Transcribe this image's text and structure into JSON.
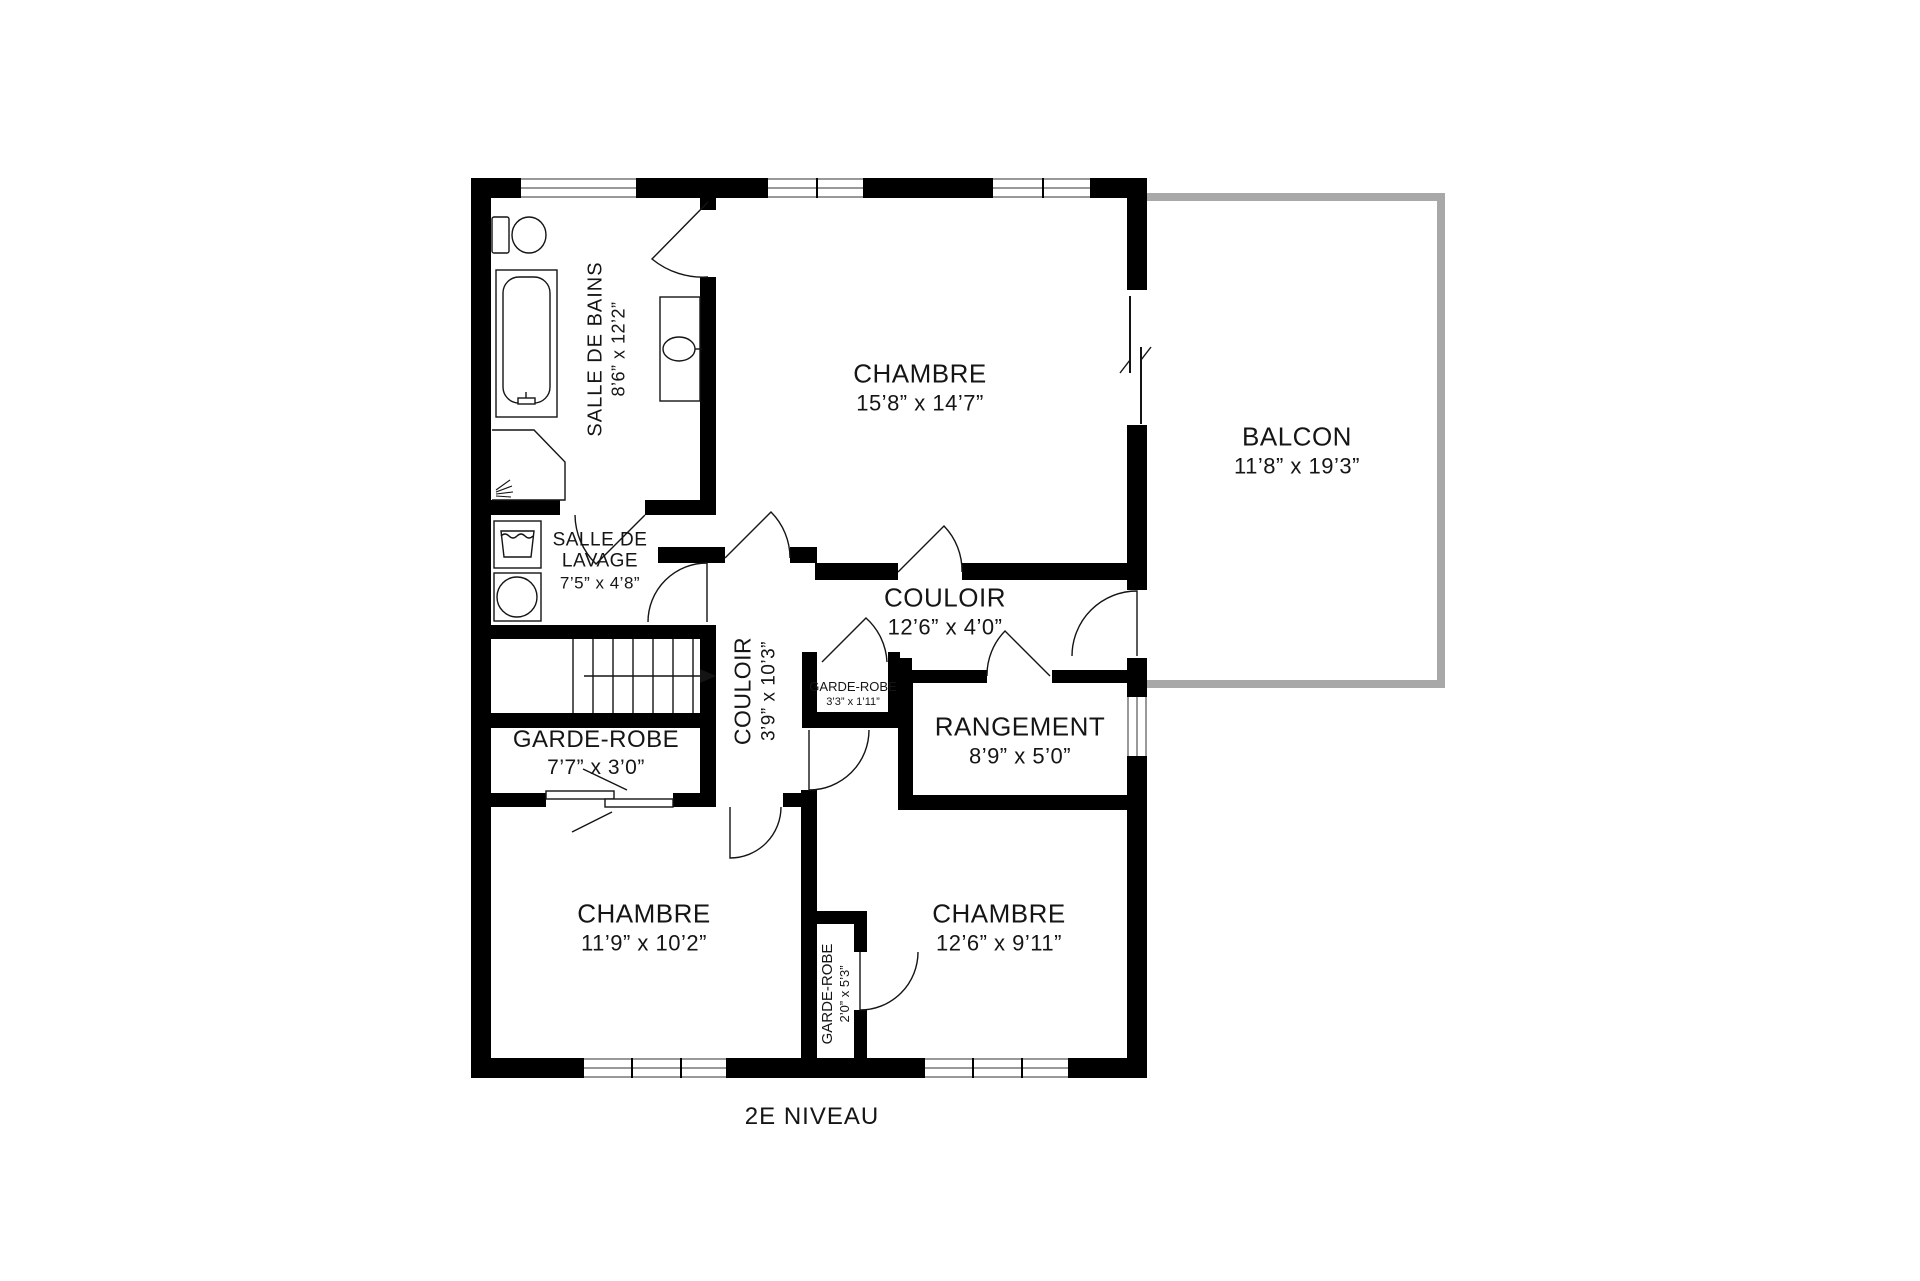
{
  "title": "2E NIVEAU",
  "rooms": [
    {
      "id": "salle-de-bains",
      "name": "SALLE DE BAINS",
      "dims": "8’6” x 12’2”",
      "orientation": "vertical"
    },
    {
      "id": "chambre-principale",
      "name": "CHAMBRE",
      "dims": "15’8” x 14’7”",
      "orientation": "horizontal"
    },
    {
      "id": "balcon",
      "name": "BALCON",
      "dims": "11’8” x 19’3”",
      "orientation": "horizontal"
    },
    {
      "id": "salle-de-lavage",
      "name": "SALLE DE\nLAVAGE",
      "dims": "7’5” x 4’8”",
      "orientation": "horizontal"
    },
    {
      "id": "couloir-horizontal",
      "name": "COULOIR",
      "dims": "12’6” x 4’0”",
      "orientation": "horizontal"
    },
    {
      "id": "couloir-vertical",
      "name": "COULOIR",
      "dims": "3’9” x 10’3”",
      "orientation": "vertical"
    },
    {
      "id": "garde-robe-petit",
      "name": "GARDE-ROBE",
      "dims": "3’3” x 1’11”",
      "orientation": "horizontal"
    },
    {
      "id": "rangement",
      "name": "RANGEMENT",
      "dims": "8’9” x 5’0”",
      "orientation": "horizontal"
    },
    {
      "id": "garde-robe",
      "name": "GARDE-ROBE",
      "dims": "7’7” x 3’0”",
      "orientation": "horizontal"
    },
    {
      "id": "chambre-sud-ouest",
      "name": "CHAMBRE",
      "dims": "11’9” x 10’2”",
      "orientation": "horizontal"
    },
    {
      "id": "chambre-sud-est",
      "name": "CHAMBRE",
      "dims": "12’6” x 9’11”",
      "orientation": "horizontal"
    },
    {
      "id": "garde-robe-strip",
      "name": "GARDE-ROBE",
      "dims": "2’0” x 5’3”",
      "orientation": "vertical"
    }
  ],
  "colors": {
    "wall": "#000000",
    "balcony_rail": "#a8a8a8",
    "window_line": "#999999",
    "text": "#151515",
    "background": "#ffffff"
  }
}
